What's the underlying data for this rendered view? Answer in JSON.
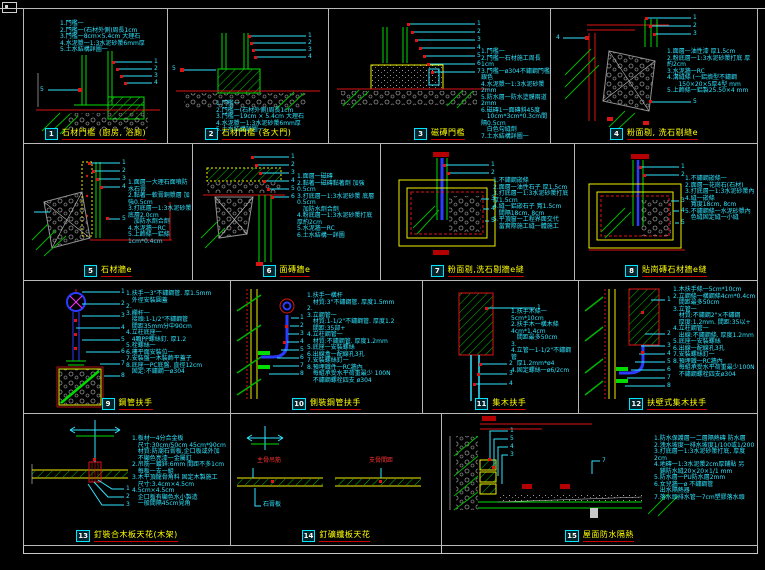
{
  "sheet": {
    "background": "#000000",
    "border_color": "#c8c8c8",
    "accent_colors": {
      "line_green": "#00dc00",
      "line_yellow": "#f0f000",
      "line_red": "#dc1414",
      "note_cyan": "#2fe4ff",
      "pipe_blue": "#2b3bff",
      "magenta": "#ff30ff",
      "title_yellow": "#ffff00",
      "hatch_gray": "#909090"
    }
  },
  "panels": [
    {
      "num": "1",
      "title": "石材門檻 (廚房, 浴廁)",
      "leaders": [
        "1",
        "2",
        "3",
        "4",
        "5"
      ],
      "notes": [
        "1.門檻一",
        "2.門檻一(石材外側)周長1cm",
        "3.門檻一8cm×5.4cm 大理石",
        "4.水泥漿一1:3水泥砂漿6mm厚",
        "5.土水結構詳圖一"
      ]
    },
    {
      "num": "2",
      "title": "石材門檻 (各大門)",
      "leaders": [
        "1",
        "2",
        "3",
        "4",
        "5"
      ],
      "notes": [
        "1.門檻一",
        "2.門檻一(石材外側)周長1cm",
        "3.門檻一19cm × 5.4cm 大理石",
        "4.水泥漿一1:3水泥砂漿6mm厚",
        "5.土水結構詳圖一"
      ]
    },
    {
      "num": "3",
      "title": "磁磚門檻",
      "leaders": [
        "1",
        "2",
        "3",
        "4",
        "5",
        "6",
        "7"
      ],
      "notes": [
        "1.門檻一",
        "2.門檻一石材施工周長1cm",
        "3.門檻一ø304不鏽鋼門檻 銀色",
        "4.水泥漿一1:3水泥砂漿2mm",
        "5.防水層一防水塗膜兩道2mm",
        "6.磁磚1一面磚斜45度",
        "   10cm*3cm*0.3cm間隔0.5cm",
        "   白色勾縫劑",
        "7.土水結構詳圖一"
      ]
    },
    {
      "num": "4",
      "title": "粉面剔, 洗石剔縫e",
      "leaders": [
        "1",
        "2",
        "3",
        "4",
        "5"
      ],
      "notes": [
        "1.面層一油性漆 厚1.5cm",
        "2.粉底層一1:3水泥砂漿打底 厚約2cm",
        "3.水泥牆一RC",
        "4.溝縫條 (一鋁擠型不鏽鋼",
        "      150×20×5厚4型 mm",
        "5.上飾條一鋁製25.50×4 mm"
      ]
    },
    {
      "num": "5",
      "title": "石材牆e",
      "leaders": [
        "1",
        "2",
        "3",
        "4",
        "5"
      ],
      "notes": [
        "1.面層一大理石面噴防水石膏",
        "2.黏著一軟膏銅漿層 加強0.5cm",
        "3.打底層一1:3水泥砂漿 底層2.0cm",
        "   加防水劑合劑",
        "4.水泥牆一RC",
        "5.上飾條一鋁條1cm*0.4cm"
      ]
    },
    {
      "num": "6",
      "title": "面磚牆e",
      "leaders": [
        "1",
        "2",
        "3",
        "4",
        "5",
        "6"
      ],
      "notes": [
        "1.面層一磁磚",
        "2.黏著一磁磚黏著劑 加強0.5cm",
        "3.打底層一1:3水泥砂漿 底層0.5cm",
        "   加防水劑合劑",
        "4.粉底層一1:3水泥砂漿打底 厚約2cm",
        "5.水泥牆一RC",
        "6.土水結構一詳圖"
      ]
    },
    {
      "num": "7",
      "title": "粉面剔,洗石剔牆e縫",
      "leaders": [
        "1",
        "2",
        "3",
        "4",
        "5"
      ],
      "notes": [
        "1.不鏽鋼嵌條",
        "2.面層一油性石子 厚1.5cm",
        "3.打底層一1:3水泥砂漿打底 厚1.5cm",
        "4.縫一鋁嵌石子 寬1.5cm",
        "   間隔18cm, 8cm",
        "5.平頂窗一工程界面交代",
        "   當實際施工縫一體施工"
      ]
    },
    {
      "num": "8",
      "title": "貼崗磚石材牆e縫",
      "leaders": [
        "1",
        "2",
        "3",
        "4",
        "5"
      ],
      "notes": [
        "1.不鏽鋼嵌條一",
        "2.面層一花崗石(石材)",
        "3.打底層一1:3水泥砂漿內",
        "4.縫一嵌條",
        "   寬度18cm, 8cm",
        "5.不鏽鋼條一水泥砂漿內",
        "   色縫固定縫一小縫"
      ]
    },
    {
      "num": "9",
      "title": "鋼管扶手",
      "leaders": [
        "1",
        "2",
        "3",
        "4",
        "5",
        "6",
        "7",
        "8"
      ],
      "notes": [
        "1.扶手一3\"不鏽鋼管. 厚1.5mm",
        "   外徑安裝圓蓋",
        "2.",
        "3.欄杆一",
        "   接頭:1-1/2\"不鏽鋼管",
        "   間距35mm分中90cm",
        "4.立柱底座一",
        "   4顆PP螺絲釘. 厚1.2",
        "5.栓螺絲一",
        "6.樓平面安裝位一",
        "7.安裝盤一木裝飾平蓋子",
        "8.底座一PC底盤. 直徑12cm",
        "   固定:不鏽鋼一ø304"
      ]
    },
    {
      "num": "10",
      "title": "側裝鋼管扶手",
      "leaders": [
        "1",
        "2",
        "3",
        "4",
        "5",
        "6",
        "7",
        "8"
      ],
      "notes": [
        "1.扶手一橫杆",
        "   材質:3\"不鏽鋼管. 厚度1.5mm",
        "2.",
        "3.立鋼管一",
        "   材質:1-1/2\"不鏽鋼管. 厚度1.2",
        "   間距:35部+",
        "4.立柱鋼管一",
        "   材質:不鏽鋼管. 厚度1.2mm",
        "5.底座一安裝螺絲",
        "6.出線盒一配線孔3孔",
        "7.安裝螺絲釘一",
        "8.預埋鐵件一RC牆內",
        "   每組承受水平荷重最少 100N",
        "   不鏽鋼螺栓四支 ø304"
      ]
    },
    {
      "num": "11",
      "title": "集木扶手",
      "leaders": [
        "1",
        "2",
        "3",
        "4"
      ],
      "notes": [
        "1.扶手木條一5cm*10cm",
        "2.扶手木一橫木條4cm*1.4cm",
        "   間距最多50cm",
        "3.",
        "4.立管一1-1/2\"不鏽鋼管",
        "   厚1.2mm*ø4",
        "4.固定螺絲一ø6/2cm"
      ]
    },
    {
      "num": "12",
      "title": "扶壁式集木扶手",
      "leaders": [
        "1",
        "2",
        "3",
        "4",
        "5",
        "6",
        "7",
        "8"
      ],
      "notes": [
        "1.木扶手條一5cm*10cm",
        "2.立鋼條一橫鋼條4cm*0.4cm",
        "   間距最多50cm",
        "3.立管一",
        "   材質:不鏽鋼2\"×不鏽鋼",
        "   厚度:1.2mm. 間距:35以+",
        "4.立柱鋼管一",
        "   出線:不鏽鋼條. 厚度1.2mm",
        "5.底座一安裝螺絲",
        "6.出線一配線孔3孔",
        "7.安裝螺絲釘一",
        "8.預埋鐵一RC牆內",
        "   每組承受水平荷重最少100N",
        "   不鏽鋼螺栓四支ø304"
      ]
    },
    {
      "num": "13",
      "title": "釘裝合木板天花(木架)",
      "leaders": [
        "1",
        "2",
        "3"
      ],
      "notes": [
        "1.板材一4分合金板",
        "   尺寸:30cm/50cm  45cm*90cm",
        "   材質:防潮石膏板,企口板或外加",
        "   不顯色亮漆一金屬釘",
        "2.吊筋一鍍鋅:6mm 間距不多1cm",
        "   每板一支一組",
        "3.木平頂龍骨角料 固定木製施工",
        "   尺寸:3.4cm×4.5cm  4.5cm×4.5cm",
        "   企口板有顯色水小製造",
        "   一般間隔45cm見角"
      ]
    },
    {
      "num": "14",
      "title": "釘礦纖板天花",
      "leaders": [],
      "notes": [],
      "labels": {
        "left_red": "主骨吊筋",
        "right_red": "支骨間距",
        "gypsum": "石膏板"
      }
    },
    {
      "num": "15",
      "title": "屋面防水隔熱",
      "leaders": [
        "1",
        "5",
        "4",
        "3",
        "7"
      ],
      "notes": [
        "1.防水保護層一二層隔熱磚 防水層",
        "2.洩水坡度一排水坡度1/100或1/200",
        "3.打底層一1:3水泥砂漿打底, 厚度2cm",
        "4.地磚一1:3水泥漿2cm厚鋪貼 另",
        "   鋪防水縫20×20×1/1 mm",
        "5.防水層一PU防水層2mm",
        "6.女兒牆一ø 不鏽鋼管",
        "   出水隔熱器",
        "7.落水頭排水管一7cm塑膠落水頭"
      ]
    }
  ]
}
